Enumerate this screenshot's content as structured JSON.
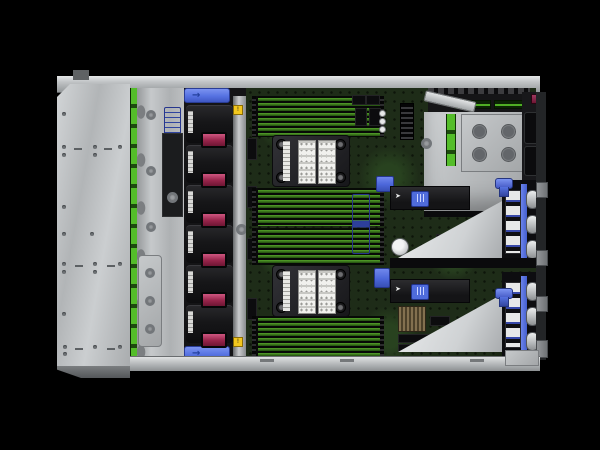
{
  "meta": {
    "subject": "rack server internal top view, cover removed",
    "style": "studio product photo on black background"
  },
  "palette": {
    "background": "#000000",
    "chassis_metal": "#c7c9cb",
    "brushed_tray": "#c2c5c7",
    "pcb_green": "#1e2c18",
    "dimm_edge_green": "#4c9426",
    "backplane_green": "#54bd2a",
    "fan_black": "#141416",
    "fan_handle_maroon": "#96244a",
    "touchpoint_blue": "#4f6cdb",
    "warning_yellow": "#f2c71d",
    "label_white": "#f1f1ee",
    "bronze_heatsink": "#83704f",
    "battery_silver": "#d7d9da"
  },
  "chassis": {
    "fans": {
      "count": 6
    },
    "memory": {
      "banks": 4,
      "slots_per_bank": 8
    },
    "cpus": {
      "heatsink_count": 2
    },
    "risers": {
      "count": 2,
      "oval_latches_each": 3
    },
    "psu_bays": {
      "count": 2
    },
    "drive_backplane": {
      "segmented_green_strip": true
    }
  },
  "icons": {
    "arrow_right": "→",
    "pointer": "➤",
    "warning": "!"
  }
}
